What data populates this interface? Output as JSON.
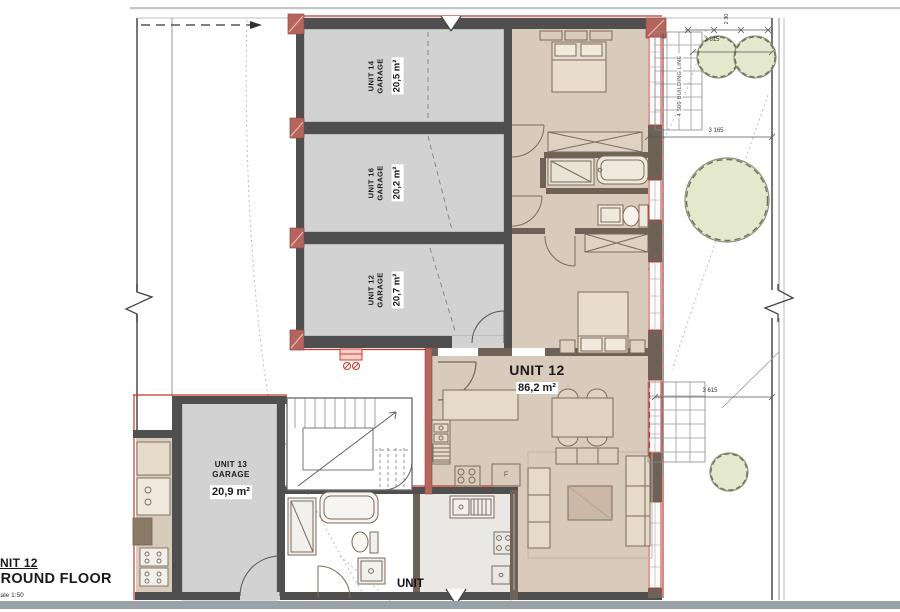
{
  "title_block": {
    "unit": "UNIT 12",
    "floor": "GROUND FLOOR",
    "scale": "Scale 1:50"
  },
  "labels": {
    "garage14": {
      "name": "UNIT 14",
      "type": "GARAGE",
      "area": "20,5 m²"
    },
    "garage16": {
      "name": "UNIT 16",
      "type": "GARAGE",
      "area": "20,2 m²"
    },
    "garage12": {
      "name": "UNIT 12",
      "type": "GARAGE",
      "area": "20,7 m²"
    },
    "garage13": {
      "name": "UNIT 13",
      "type": "GARAGE",
      "area": "20,9 m²"
    },
    "unit12": {
      "name": "UNIT 12",
      "area": "86,2 m²"
    },
    "unit_cut": "UNIT",
    "fridge": "F"
  },
  "dimensions": {
    "top_width": "3 615",
    "top_height": "2 30",
    "mid_width": "3 165",
    "lower_width": "3 615"
  },
  "annotations": {
    "building_line": "4 500 BUILDING LINE"
  },
  "colors": {
    "floor_beige": "#d9cbbc",
    "garage_gray": "#d2d2d2",
    "wall_dark": "#4f4f4f",
    "wall_brown": "#6e6257",
    "red_wall": "#b5655d",
    "window_red": "#c0392b",
    "tree_fill": "#e4e9cd",
    "bottom_band": "#9aa2a7"
  }
}
